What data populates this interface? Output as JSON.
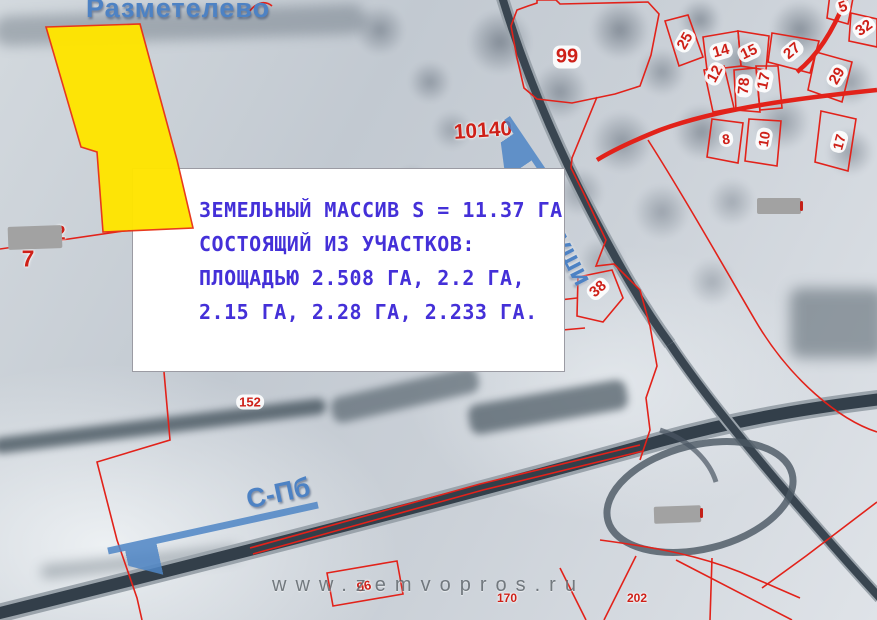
{
  "map": {
    "settlement_label": "Разметелево",
    "watermark_text": "www.zemvopros.ru",
    "direction_labels": {
      "spb": "С-Пб",
      "koltushi": "Колтуши"
    },
    "info_box": {
      "lines": [
        "ЗЕМЕЛЬНЫЙ МАССИВ S = 11.37 ГА",
        "СОСТОЯЩИЙ ИЗ УЧАСТКОВ:",
        "ПЛОЩАДЬЮ 2.508 ГА, 2.2 ГА,",
        "2.15 ГА, 2.28 ГА, 2.233 ГА."
      ]
    },
    "colors": {
      "parcel_highlight": "#FFE500",
      "cadastral_line": "#E2221A",
      "annotation_text": "#4430D8",
      "direction_arrow": "#4F86C6",
      "settlement_text": "#4D82C4",
      "watermark": "#555C63"
    },
    "parcel_labels": [
      {
        "text": "99",
        "x": 567,
        "y": 57,
        "rot": 0,
        "size": 20,
        "chip": true
      },
      {
        "text": "10140",
        "x": 483,
        "y": 131,
        "rot": -4,
        "size": 21,
        "chip": false
      },
      {
        "text": "7",
        "x": 28,
        "y": 259,
        "rot": 0,
        "size": 23,
        "chip": false
      },
      {
        "text": "2",
        "x": 60,
        "y": 234,
        "rot": 0,
        "size": 20,
        "chip": false
      },
      {
        "text": "152",
        "x": 250,
        "y": 402,
        "rot": 0,
        "size": 13,
        "chip": true
      },
      {
        "text": "38",
        "x": 598,
        "y": 289,
        "rot": -42,
        "size": 15,
        "chip": true
      },
      {
        "text": "96",
        "x": 364,
        "y": 586,
        "rot": -12,
        "size": 13,
        "chip": false
      },
      {
        "text": "170",
        "x": 507,
        "y": 598,
        "rot": 0,
        "size": 12,
        "chip": false
      },
      {
        "text": "202",
        "x": 637,
        "y": 598,
        "rot": 0,
        "size": 12,
        "chip": false
      },
      {
        "text": "25",
        "x": 685,
        "y": 41,
        "rot": -60,
        "size": 15,
        "chip": true
      },
      {
        "text": "14",
        "x": 721,
        "y": 51,
        "rot": -15,
        "size": 15,
        "chip": true
      },
      {
        "text": "15",
        "x": 749,
        "y": 52,
        "rot": -25,
        "size": 15,
        "chip": true
      },
      {
        "text": "27",
        "x": 792,
        "y": 51,
        "rot": -40,
        "size": 15,
        "chip": true
      },
      {
        "text": "12",
        "x": 715,
        "y": 74,
        "rot": -62,
        "size": 15,
        "chip": true
      },
      {
        "text": "78",
        "x": 744,
        "y": 86,
        "rot": -85,
        "size": 15,
        "chip": true
      },
      {
        "text": "17",
        "x": 764,
        "y": 81,
        "rot": -78,
        "size": 15,
        "chip": true
      },
      {
        "text": "29",
        "x": 837,
        "y": 76,
        "rot": -60,
        "size": 15,
        "chip": true
      },
      {
        "text": "5",
        "x": 843,
        "y": 7,
        "rot": -20,
        "size": 15,
        "chip": true
      },
      {
        "text": "32",
        "x": 864,
        "y": 28,
        "rot": -35,
        "size": 15,
        "chip": true
      },
      {
        "text": "8",
        "x": 726,
        "y": 139,
        "rot": -8,
        "size": 14,
        "chip": true
      },
      {
        "text": "10",
        "x": 764,
        "y": 139,
        "rot": -80,
        "size": 14,
        "chip": true
      },
      {
        "text": "17",
        "x": 839,
        "y": 142,
        "rot": -75,
        "size": 14,
        "chip": true
      }
    ]
  }
}
